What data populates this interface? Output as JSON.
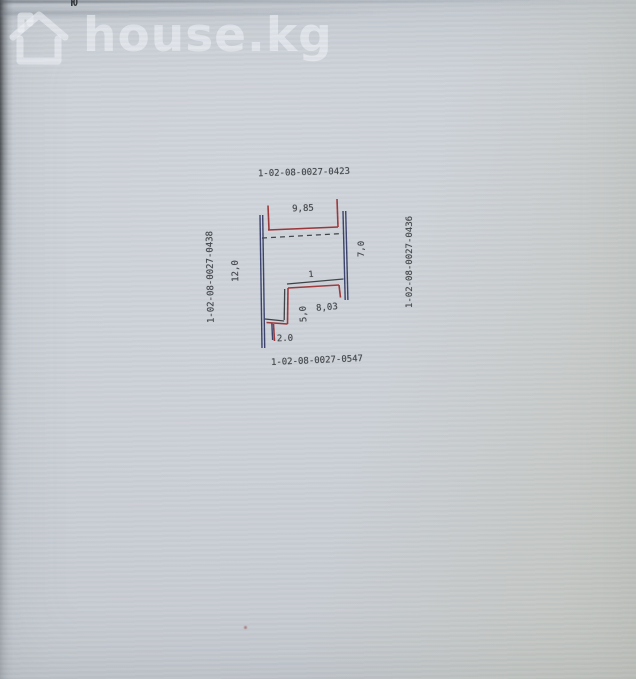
{
  "photo": {
    "top_edge_char": "Ю"
  },
  "watermark": {
    "brand": "house.kg",
    "icon": "house-outline-icon"
  },
  "plan": {
    "parcel_top": "1-02-08-0027-0423",
    "parcel_left": "1-02-08-0027-0438",
    "parcel_right": "1-02-08-0027-0436",
    "parcel_bottom": "1-02-08-0027-0547",
    "dim_top_width": "9,85",
    "dim_left_height": "12,0",
    "dim_right_height": "7,0",
    "dim_inner_width": "8,03",
    "dim_inner_height": "5,0",
    "dim_bottom_offset": "2.0",
    "point_label": "1"
  },
  "colors": {
    "red_line": "#9d3638",
    "blue_line": "#39406a",
    "dark_line": "#3c4145"
  }
}
